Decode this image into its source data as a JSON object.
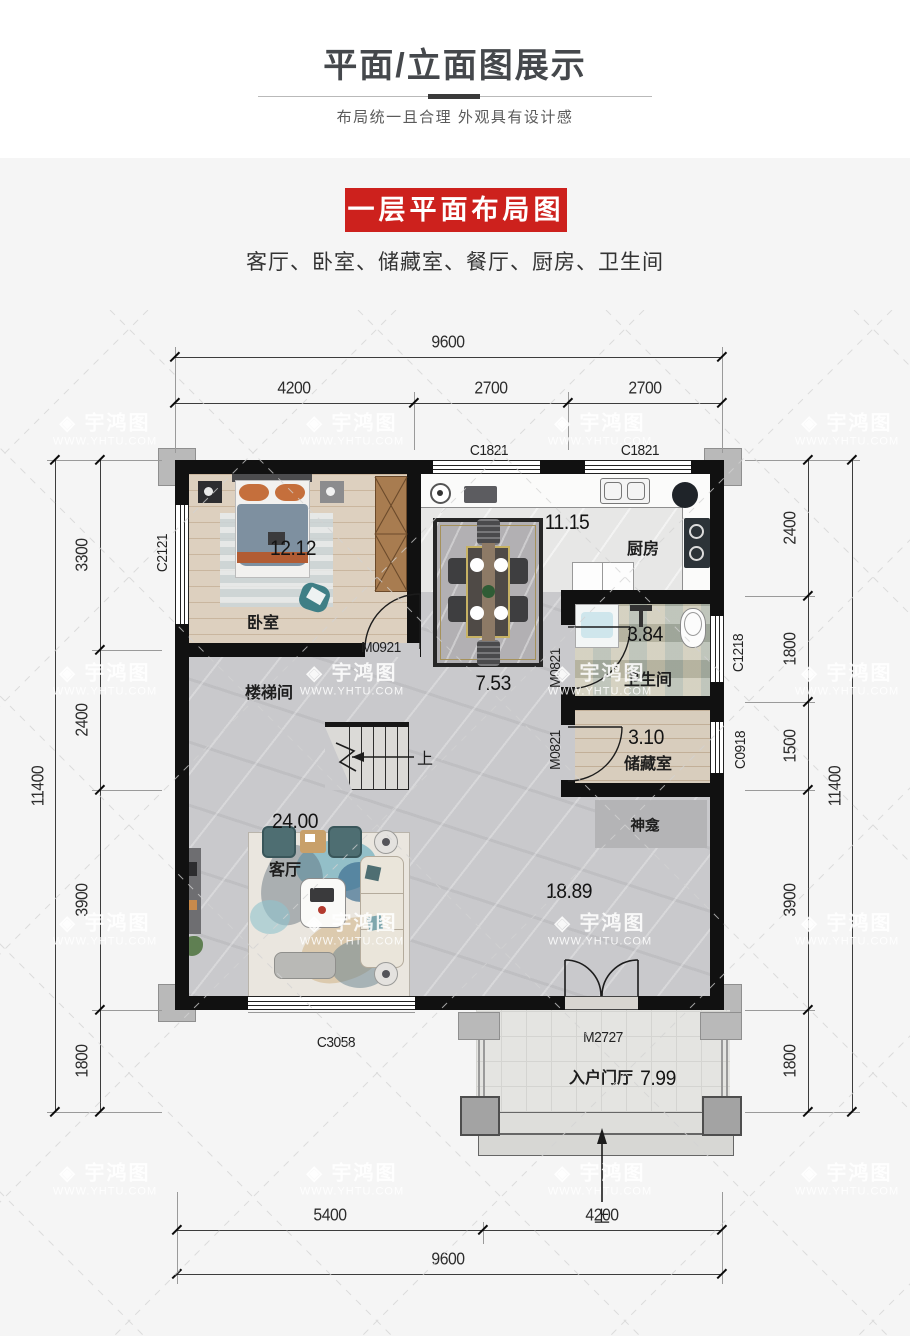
{
  "header": {
    "title": "平面/立面图展示",
    "subtitle": "布局统一且合理 外观具有设计感",
    "banner": "一层平面布局图",
    "room_list": "客厅、卧室、储藏室、餐厅、厨房、卫生间"
  },
  "watermark": {
    "logo": "宇鸿图",
    "url": "WWW.YHTU.COM"
  },
  "colors": {
    "accent_red": "#cd211d",
    "wall": "#111111"
  },
  "plan": {
    "rooms": {
      "bedroom": {
        "label": "卧室",
        "area": "12.12"
      },
      "stairwell": {
        "label": "楼梯间",
        "up": "上"
      },
      "kitchen": {
        "label": "厨房",
        "area": "11.15"
      },
      "dining": {
        "area": "7.53"
      },
      "bathroom": {
        "label": "卫生间",
        "area": "3.84"
      },
      "storage": {
        "label": "储藏室",
        "area": "3.10"
      },
      "shrine": {
        "label": "神龛"
      },
      "living": {
        "label": "客厅",
        "area": "24.00"
      },
      "hall": {
        "area": "18.89"
      },
      "foyer": {
        "label": "入户门厅",
        "area": "7.99",
        "up": "上"
      }
    },
    "doors": {
      "bedroom": "M0921",
      "bathroom": "M0821",
      "storage": "M0821",
      "entry": "M2727"
    },
    "windows": {
      "kitchen_left": "C1821",
      "kitchen_right": "C1821",
      "bedroom": "C2121",
      "bathroom": "C1218",
      "storage": "C0918",
      "living": "C3058"
    },
    "dims": {
      "top": {
        "total": "9600",
        "segments": [
          "4200",
          "2700",
          "2700"
        ]
      },
      "bottom": {
        "total": "9600",
        "segments": [
          "5400",
          "4200"
        ]
      },
      "left": {
        "total": "11400",
        "segments": [
          "3300",
          "2400",
          "3900",
          "1800"
        ]
      },
      "right": {
        "total": "11400",
        "segments": [
          "2400",
          "1800",
          "1500",
          "3900",
          "1800"
        ]
      }
    }
  }
}
